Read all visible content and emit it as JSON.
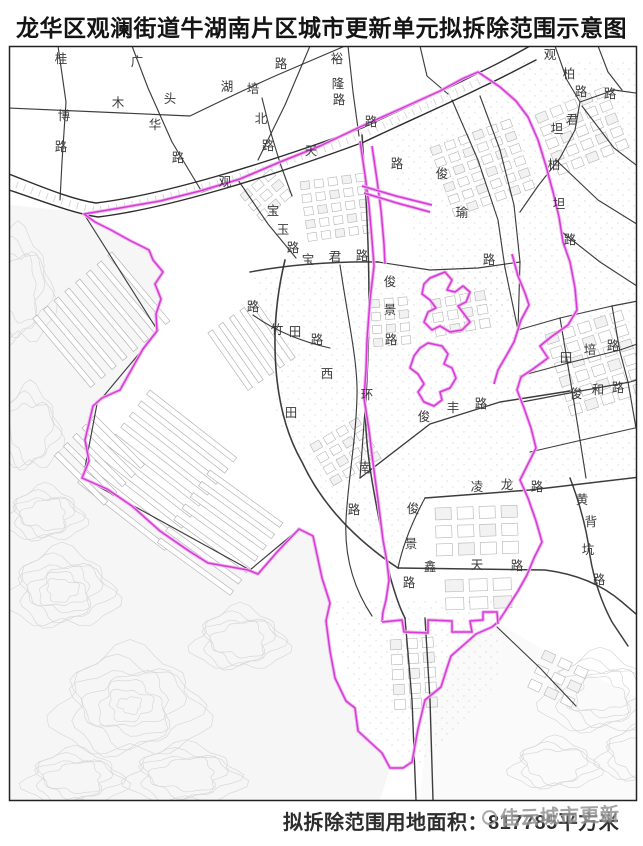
{
  "title": "龙华区观澜街道牛湖南片区城市更新单元拟拆除范围示意图",
  "caption": "拟拆除范围用地面积：817785平方米",
  "watermark": "佳云城市更新",
  "colors": {
    "boundary": "#d63ad6",
    "boundary_glow": "#f0b3f0",
    "road": "#2d2d2d",
    "parcel": "#b5b5b5",
    "contour": "#d8d8d8",
    "label": "#3a3a3a",
    "border": "#222222"
  },
  "map": {
    "border": {
      "x": 9.5,
      "y": 46.5,
      "w": 627,
      "h": 754
    },
    "fills": [
      {
        "f": "#f6f6f6",
        "pts": "9,205 60,210 84,214 95,222 129,240 149,250 163,272 155,284 161,299 156,314 157,331 143,349 120,390 93,406 85,440 89,461 82,478 107,489 132,506 160,531 189,551 208,563 248,570 258,574 278,551 299,529 313,536 322,578 330,603 326,621 330,651 335,678 346,701 355,708 358,731 382,753 390,768 380,800 9,800"
      },
      {
        "f": "#fafafa",
        "pts": "497,622 560,660 643,700 643,800 420,800 430,700 445,660"
      }
    ],
    "contours": [
      {
        "cx": 62,
        "cy": 590,
        "rx": 52,
        "ry": 38,
        "n": 6
      },
      {
        "cx": 130,
        "cy": 705,
        "rx": 72,
        "ry": 52,
        "n": 7
      },
      {
        "cx": 45,
        "cy": 515,
        "rx": 38,
        "ry": 26,
        "n": 4
      },
      {
        "cx": 185,
        "cy": 775,
        "rx": 55,
        "ry": 28,
        "n": 4
      },
      {
        "cx": 75,
        "cy": 778,
        "rx": 48,
        "ry": 26,
        "n": 4
      },
      {
        "cx": 240,
        "cy": 640,
        "rx": 45,
        "ry": 30,
        "n": 4
      },
      {
        "cx": 600,
        "cy": 695,
        "rx": 55,
        "ry": 38,
        "n": 5
      },
      {
        "cx": 555,
        "cy": 765,
        "rx": 42,
        "ry": 24,
        "n": 3
      },
      {
        "cx": 640,
        "cy": 755,
        "rx": 40,
        "ry": 26,
        "n": 3
      },
      {
        "cx": 30,
        "cy": 430,
        "rx": 30,
        "ry": 40,
        "n": 3
      },
      {
        "cx": 18,
        "cy": 290,
        "rx": 34,
        "ry": 55,
        "n": 4
      }
    ],
    "strips": [
      {
        "x": 112,
        "y": 252,
        "ang": 50,
        "len": 90,
        "n": 8,
        "gap": 14
      },
      {
        "x": 150,
        "y": 390,
        "ang": 38,
        "len": 110,
        "n": 9,
        "gap": 14
      },
      {
        "x": 95,
        "y": 415,
        "ang": 45,
        "len": 70,
        "n": 5,
        "gap": 13
      },
      {
        "x": 210,
        "y": 470,
        "ang": 36,
        "len": 90,
        "n": 7,
        "gap": 14
      },
      {
        "x": 255,
        "y": 300,
        "ang": 55,
        "len": 70,
        "n": 5,
        "gap": 13
      }
    ],
    "clusters": [
      {
        "x": 430,
        "y": 148,
        "a": -20,
        "cols": 6,
        "rows": 6,
        "cw": 15,
        "ch": 13,
        "bw": 10,
        "bh": 8
      },
      {
        "x": 535,
        "y": 115,
        "a": -22,
        "cols": 5,
        "rows": 5,
        "cw": 16,
        "ch": 14,
        "bw": 11,
        "bh": 9
      },
      {
        "x": 300,
        "y": 182,
        "a": -8,
        "cols": 5,
        "rows": 5,
        "cw": 14,
        "ch": 13,
        "bw": 9,
        "bh": 8
      },
      {
        "x": 430,
        "y": 300,
        "a": -10,
        "cols": 4,
        "rows": 3,
        "cw": 15,
        "ch": 14,
        "bw": 10,
        "bh": 9
      },
      {
        "x": 545,
        "y": 335,
        "a": -18,
        "cols": 5,
        "rows": 6,
        "cw": 17,
        "ch": 15,
        "bw": 12,
        "bh": 10
      },
      {
        "x": 435,
        "y": 508,
        "a": -2,
        "cols": 4,
        "rows": 3,
        "cw": 22,
        "ch": 18,
        "bw": 16,
        "bh": 12
      },
      {
        "x": 445,
        "y": 580,
        "a": -2,
        "cols": 3,
        "rows": 2,
        "cw": 24,
        "ch": 18,
        "bw": 18,
        "bh": 12
      },
      {
        "x": 310,
        "y": 445,
        "a": -30,
        "cols": 4,
        "rows": 4,
        "cw": 15,
        "ch": 13,
        "bw": 10,
        "bh": 8
      },
      {
        "x": 390,
        "y": 640,
        "a": -4,
        "cols": 3,
        "rows": 5,
        "cw": 16,
        "ch": 15,
        "bw": 11,
        "bh": 10
      },
      {
        "x": 545,
        "y": 650,
        "a": 25,
        "cols": 3,
        "rows": 3,
        "cw": 18,
        "ch": 16,
        "bw": 12,
        "bh": 9
      },
      {
        "x": 240,
        "y": 195,
        "a": -40,
        "cols": 3,
        "rows": 3,
        "cw": 15,
        "ch": 13,
        "bw": 10,
        "bh": 8
      },
      {
        "x": 370,
        "y": 300,
        "a": -5,
        "cols": 3,
        "rows": 4,
        "cw": 14,
        "ch": 13,
        "bw": 9,
        "bh": 8
      }
    ],
    "speckles": [
      "380,120 520,60 643,60 643,300 520,330 420,260",
      "250,270 380,262 420,268 520,262 518,330 520,480 425,500 398,568 346,520 300,460 272,410 270,330",
      "330,600 500,600 500,680 420,770 360,730",
      "520,330 643,300 643,480 530,490"
    ],
    "highway": [
      {
        "d": "M9,174 C40,186 70,199 96,203 C162,195 262,165 362,128 C402,109 452,87 478,73 C496,65 512,56 530,46",
        "w": 1.4
      },
      {
        "d": "M9,190 C42,201 72,213 98,217 C164,209 264,179 364,142 C404,123 454,101 482,87 C500,79 516,70 536,60",
        "w": 1.4
      }
    ],
    "highway_hatch": {
      "d": "M9,182 C41,194 71,206 97,210 C163,202 263,172 363,135 C403,116 453,94 480,80",
      "w": 7
    },
    "roads": [
      {
        "d": "M58,46 L66,102 L62,162 L60,200"
      },
      {
        "d": "M9,108 L190,116 Q235,94 275,76 L345,46"
      },
      {
        "d": "M132,46 L148,88 L172,142 L202,192"
      },
      {
        "d": "M310,46 L285,105 L258,160"
      },
      {
        "d": "M262,98 L270,130 L280,163 L292,196"
      },
      {
        "d": "M348,46 L353,92 L359,136"
      },
      {
        "d": "M420,46 L427,76 L448,94"
      },
      {
        "d": "M555,46 L567,80 L580,102 L575,130 L560,158 L538,186 L520,212"
      },
      {
        "d": "M580,102 L614,90 L643,94"
      },
      {
        "d": "M582,106 L614,148 L640,168"
      },
      {
        "d": "M598,46 L608,72 L622,90"
      },
      {
        "d": "M480,96 L500,150 L514,205 L520,262 L518,330"
      },
      {
        "d": "M452,100 L478,160 L498,220 L505,268"
      },
      {
        "d": "M505,268 L518,330"
      },
      {
        "d": "M556,160 L598,200 L640,226"
      },
      {
        "d": "M562,232 L600,262 L640,288"
      },
      {
        "d": "M518,330 L560,318 L612,306 L643,300"
      },
      {
        "d": "M520,376 L572,362 L620,350 L643,342"
      },
      {
        "d": "M522,402 L575,392 L630,382 L643,378"
      },
      {
        "d": "M530,452 L582,440 L635,428"
      },
      {
        "d": "M425,498 L530,490 L640,477",
        "w": 1.5
      },
      {
        "d": "M560,318 L572,390 L580,440 L586,478"
      },
      {
        "d": "M612,306 L620,352 L628,382 L636,428"
      },
      {
        "d": "M570,478 Q586,520 590,556 Q596,592 612,622 L628,646",
        "w": 1.5
      },
      {
        "d": "M250,272 Q310,261 378,262",
        "w": 1.5
      },
      {
        "d": "M378,262 L430,270 L478,268 L520,262"
      },
      {
        "d": "M238,180 L268,224 L296,258"
      },
      {
        "d": "M202,192 L238,180"
      },
      {
        "d": "M285,260 C268,330 272,410 302,462 C322,505 356,540 398,568",
        "w": 1.6
      },
      {
        "d": "M253,315 Q285,338 330,348"
      },
      {
        "d": "M340,265 C348,320 358,362 357,396 C356,440 348,480 346,520 C344,560 356,592 372,616"
      },
      {
        "d": "M360,478 L430,424 L500,402 L570,391",
        "w": 1.4
      },
      {
        "d": "M398,568 L545,570 Q592,576 622,602 L643,620",
        "w": 1.5
      },
      {
        "d": "M425,498 Q405,535 398,568"
      },
      {
        "d": "M405,618 L412,700 L416,800",
        "w": 1.4
      },
      {
        "d": "M425,618 L430,700 L433,800",
        "w": 1.4
      },
      {
        "d": "M497,627 L540,668 L576,706"
      },
      {
        "d": "M84,214 L158,331 L97,404 L83,478 L250,570 L299,529"
      },
      {
        "d": "M362,135 C368,220 372,300 366,396 C362,450 380,520 390,576 Q398,605 405,618",
        "w": 1.5
      },
      {
        "d": "M366,396 L360,478"
      }
    ],
    "boundary": {
      "outer": "478,72 500,87 516,101 528,117 538,140 546,166 553,192 559,217 563,242 570,262 575,288 577,310 568,325 551,337 540,346 548,358 533,369 521,377 517,390 524,408 531,428 536,448 528,464 520,480 528,498 536,521 542,542 534,558 527,575 518,591 504,613 498,622 492,627 476,634 467,642 451,656 447,668 441,687 425,700 418,729 412,762 403,768 390,768 382,753 358,731 355,708 346,701 335,678 330,651 326,621 330,603 322,578 313,536 299,529 278,551 258,574 248,570 208,563 189,551 160,531 132,506 107,489 82,478 89,461 85,440 93,406 102,398 120,390 143,349 157,331 156,314 161,299 155,284 163,272 153,260 149,250 129,240 111,230 95,222 84,214 120,208 160,201 200,191 240,179 280,162 320,146 360,127 400,109 440,91 462,79",
      "islands": [
        "430,278 445,272 452,280 447,290 455,292 463,286 470,292 466,302 458,306 464,314 470,322 462,330 450,332 440,326 432,330 424,322 428,312 436,308 430,300 422,294 424,284",
        "428,343 442,346 448,354 444,364 452,368 456,378 450,388 440,392 442,400 434,406 424,402 418,392 424,384 418,374 410,368 414,356 420,348"
      ],
      "lines": [
        "M360,141 L365,175 L369,205 L372,240 L374,266 L370,300 L367,340 L366,370 L364,398 L369,430 L372,455 L375,478 L378,500 L380,516 L383,540 L387,562 L389,580 L386,600 L383,612 L382,622",
        "M372,146 L377,180 L381,210 L384,244 L385,264",
        "M362,186 L396,196 L432,205",
        "M364,193 L397,203 L430,212",
        "M512,254 L518,276 L525,293 L529,305 L521,320 L514,342 L505,358 L498,370 L494,384",
        "M382,622 L402,620 L404,632 L428,633 L428,620 L452,621 L452,632 L472,632 L470,621 L483,620 L483,612 L497,612 L498,624"
      ]
    },
    "labels": [
      {
        "t": "桂",
        "x": 61,
        "y": 63
      },
      {
        "t": "木",
        "x": 118,
        "y": 107
      },
      {
        "t": "头",
        "x": 170,
        "y": 103
      },
      {
        "t": "华",
        "x": 155,
        "y": 129
      },
      {
        "t": "路",
        "x": 178,
        "y": 162
      },
      {
        "t": "博",
        "x": 64,
        "y": 120
      },
      {
        "t": "路",
        "x": 61,
        "y": 151
      },
      {
        "t": "广",
        "x": 137,
        "y": 66
      },
      {
        "t": "湖",
        "x": 227,
        "y": 91
      },
      {
        "t": "培",
        "x": 253,
        "y": 93
      },
      {
        "t": "北",
        "x": 261,
        "y": 123
      },
      {
        "t": "路",
        "x": 268,
        "y": 150
      },
      {
        "t": "路",
        "x": 281,
        "y": 68
      },
      {
        "t": "裕",
        "x": 337,
        "y": 63
      },
      {
        "t": "隆",
        "x": 338,
        "y": 88
      },
      {
        "t": "路",
        "x": 339,
        "y": 104
      },
      {
        "t": "观",
        "x": 225,
        "y": 186
      },
      {
        "t": "天",
        "x": 311,
        "y": 155
      },
      {
        "t": "路",
        "x": 371,
        "y": 126
      },
      {
        "t": "观",
        "x": 550,
        "y": 59
      },
      {
        "t": "柏",
        "x": 569,
        "y": 78
      },
      {
        "t": "路",
        "x": 581,
        "y": 96
      },
      {
        "t": "路",
        "x": 610,
        "y": 98
      },
      {
        "t": "君",
        "x": 572,
        "y": 124
      },
      {
        "t": "坦",
        "x": 557,
        "y": 133
      },
      {
        "t": "柏",
        "x": 554,
        "y": 169
      },
      {
        "t": "坦",
        "x": 559,
        "y": 208
      },
      {
        "t": "路",
        "x": 570,
        "y": 244
      },
      {
        "t": "俊",
        "x": 442,
        "y": 178
      },
      {
        "t": "瑜",
        "x": 462,
        "y": 217
      },
      {
        "t": "路",
        "x": 489,
        "y": 264
      },
      {
        "t": "宝",
        "x": 273,
        "y": 215
      },
      {
        "t": "玉",
        "x": 283,
        "y": 234
      },
      {
        "t": "路",
        "x": 293,
        "y": 252
      },
      {
        "t": "宝",
        "x": 308,
        "y": 264
      },
      {
        "t": "君",
        "x": 335,
        "y": 261
      },
      {
        "t": "路",
        "x": 362,
        "y": 260
      },
      {
        "t": "俊",
        "x": 390,
        "y": 286
      },
      {
        "t": "景",
        "x": 390,
        "y": 314
      },
      {
        "t": "路",
        "x": 391,
        "y": 344
      },
      {
        "t": "路",
        "x": 397,
        "y": 168
      },
      {
        "t": "路",
        "x": 253,
        "y": 311
      },
      {
        "t": "竹",
        "x": 277,
        "y": 334
      },
      {
        "t": "田",
        "x": 295,
        "y": 336
      },
      {
        "t": "路",
        "x": 317,
        "y": 344
      },
      {
        "t": "西",
        "x": 327,
        "y": 378
      },
      {
        "t": "田",
        "x": 291,
        "y": 417
      },
      {
        "t": "环",
        "x": 367,
        "y": 399
      },
      {
        "t": "南",
        "x": 365,
        "y": 472
      },
      {
        "t": "路",
        "x": 354,
        "y": 514
      },
      {
        "t": "田",
        "x": 566,
        "y": 362
      },
      {
        "t": "培",
        "x": 590,
        "y": 354
      },
      {
        "t": "路",
        "x": 613,
        "y": 350
      },
      {
        "t": "俊",
        "x": 576,
        "y": 398
      },
      {
        "t": "和",
        "x": 598,
        "y": 394
      },
      {
        "t": "路",
        "x": 618,
        "y": 392
      },
      {
        "t": "俊",
        "x": 424,
        "y": 421
      },
      {
        "t": "丰",
        "x": 453,
        "y": 412
      },
      {
        "t": "路",
        "x": 481,
        "y": 408
      },
      {
        "t": "凌",
        "x": 477,
        "y": 491
      },
      {
        "t": "龙",
        "x": 507,
        "y": 489
      },
      {
        "t": "路",
        "x": 537,
        "y": 491
      },
      {
        "t": "俊",
        "x": 413,
        "y": 513
      },
      {
        "t": "景",
        "x": 411,
        "y": 548
      },
      {
        "t": "路",
        "x": 409,
        "y": 587
      },
      {
        "t": "鑫",
        "x": 430,
        "y": 571
      },
      {
        "t": "天",
        "x": 477,
        "y": 569
      },
      {
        "t": "路",
        "x": 517,
        "y": 570
      },
      {
        "t": "黄",
        "x": 582,
        "y": 504
      },
      {
        "t": "背",
        "x": 591,
        "y": 526
      },
      {
        "t": "坑",
        "x": 588,
        "y": 554
      },
      {
        "t": "路",
        "x": 599,
        "y": 584
      }
    ]
  }
}
